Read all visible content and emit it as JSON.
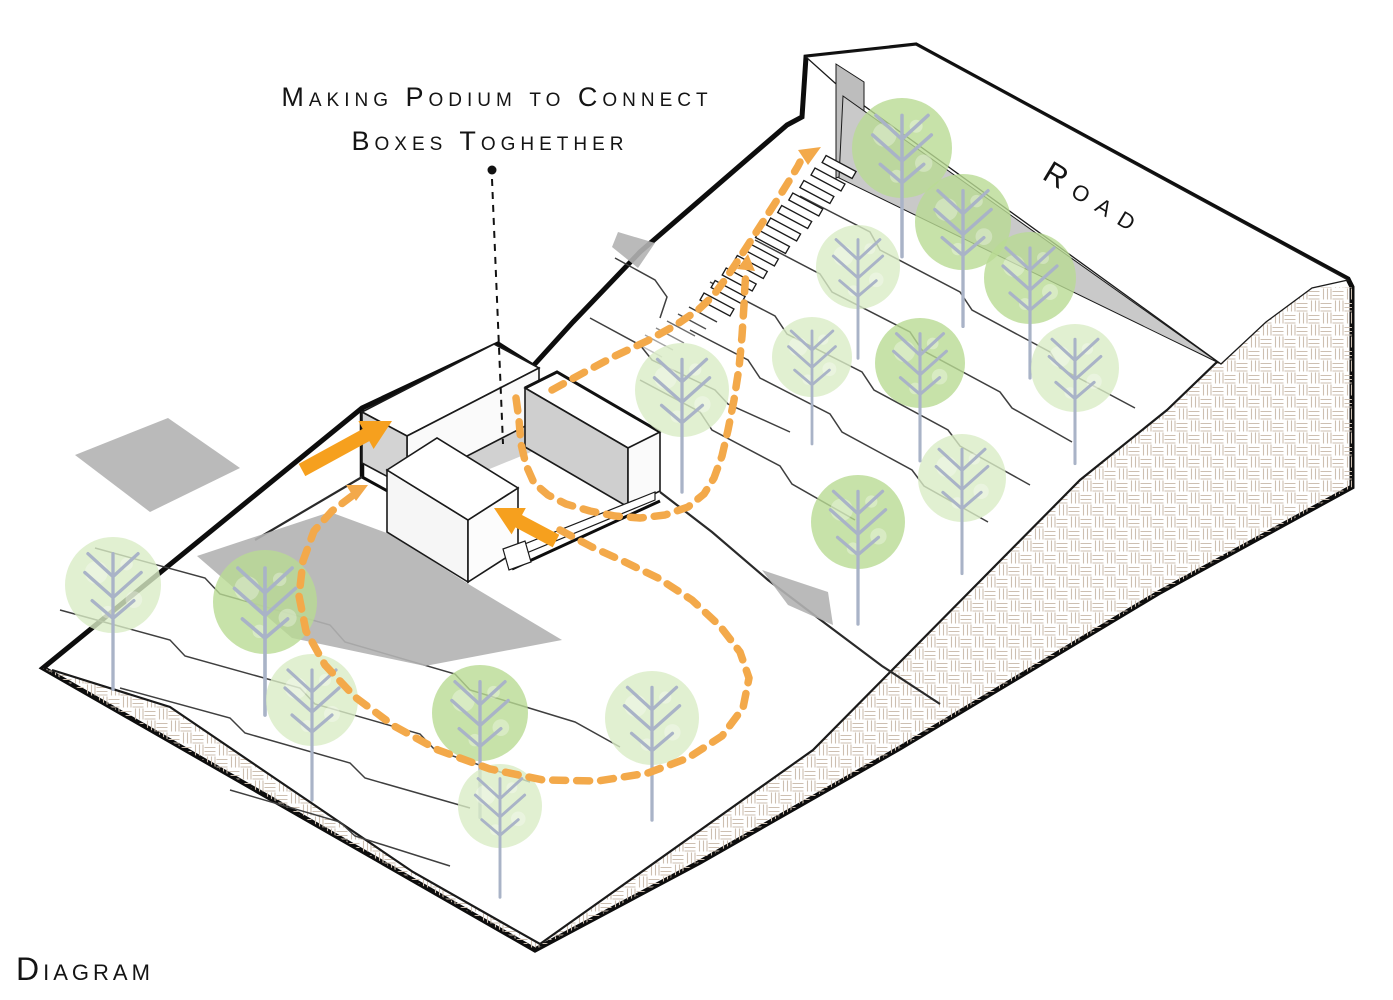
{
  "labels": {
    "title_line1": "Making Podium to Connect",
    "title_line2": "Boxes Toghether",
    "road": "Road",
    "diagram": "Diagram"
  },
  "colors": {
    "outline": "#0D0D0D",
    "line_medium": "#2A2A2A",
    "contour": "#3F3F3F",
    "hatch": "#CDBFB1",
    "wall_grey": "#C9C9C9",
    "wall_cap_grey": "#BDBDBD",
    "shadow_grey": "#B2B2B2",
    "box_side_grey": "#D3D3D3",
    "box_side_grey2": "#CFCFCF",
    "tree_light": "#D9ECC5",
    "tree_dark": "#B9DB94",
    "trunk": "#A9B3C7",
    "path_orange": "#F3A94A",
    "arrow_orange": "#F6A01E"
  },
  "scene": {
    "width": 1393,
    "height": 1000,
    "trees": [
      {
        "x": 113,
        "y": 585,
        "r": 48,
        "shade": "light"
      },
      {
        "x": 265,
        "y": 602,
        "r": 52,
        "shade": "dark"
      },
      {
        "x": 312,
        "y": 700,
        "r": 46,
        "shade": "light"
      },
      {
        "x": 480,
        "y": 713,
        "r": 48,
        "shade": "dark"
      },
      {
        "x": 500,
        "y": 806,
        "r": 42,
        "shade": "light"
      },
      {
        "x": 652,
        "y": 718,
        "r": 47,
        "shade": "light"
      },
      {
        "x": 682,
        "y": 390,
        "r": 47,
        "shade": "light"
      },
      {
        "x": 858,
        "y": 522,
        "r": 47,
        "shade": "dark"
      },
      {
        "x": 962,
        "y": 478,
        "r": 44,
        "shade": "light"
      },
      {
        "x": 902,
        "y": 148,
        "r": 50,
        "shade": "dark"
      },
      {
        "x": 963,
        "y": 222,
        "r": 48,
        "shade": "dark"
      },
      {
        "x": 1030,
        "y": 278,
        "r": 46,
        "shade": "dark"
      },
      {
        "x": 858,
        "y": 267,
        "r": 42,
        "shade": "light"
      },
      {
        "x": 812,
        "y": 357,
        "r": 40,
        "shade": "light"
      },
      {
        "x": 920,
        "y": 363,
        "r": 45,
        "shade": "dark"
      },
      {
        "x": 1075,
        "y": 368,
        "r": 44,
        "shade": "light"
      }
    ],
    "shapes": [
      {
        "t": "path",
        "name": "terrain-surface",
        "d": "M43,668 L362,408 L498,344 L533,366 L573,322 L640,252 L787,125 L802,117 L806,57 L916,45 L1348,279 L1352,287 L1352,487 L1160,592 L900,748 L700,862 L535,950 Z",
        "fill": "#FFFFFF",
        "stroke": "#0D0D0D",
        "w": 5
      },
      {
        "t": "path",
        "name": "cut-face-hatch",
        "d": "M43,668 L535,950 L700,862 L900,748 L1160,592 L1352,487 L1352,287 L1312,287 L1245,335 L1167,410 L1080,480 L813,750 L540,944 L413,872 L170,707 L52,670 Z",
        "fill": "url(#weave)"
      },
      {
        "t": "path",
        "name": "cut-face-inner-edge",
        "d": "M52,670 L170,707 L413,872 L540,944 L813,750 L1080,480 L1167,410 L1245,335 L1312,287",
        "stroke": "#1A1A1A",
        "w": 2.2
      },
      {
        "t": "path",
        "name": "contour-line",
        "d": "M95,548 L205,578 L220,594 L330,625 L345,642 L455,674 L470,690 L575,722 L620,747",
        "stroke": "#3F3F3F",
        "w": 1.5
      },
      {
        "t": "path",
        "name": "contour-line",
        "d": "M60,610 L170,640 L185,656 L300,688 L315,704 L420,734 L435,750 L530,782",
        "stroke": "#3F3F3F",
        "w": 1.5
      },
      {
        "t": "path",
        "name": "contour-line",
        "d": "M120,688 L230,718 L245,733 L350,763 L365,778 L470,808",
        "stroke": "#3F3F3F",
        "w": 1.5
      },
      {
        "t": "path",
        "name": "contour-line",
        "d": "M230,790 L340,822 L355,836 L450,866",
        "stroke": "#3F3F3F",
        "w": 1.5
      },
      {
        "t": "path",
        "name": "contour-line",
        "d": "M590,318 L640,345 L652,360 L715,390 L728,404 L790,432",
        "stroke": "#3F3F3F",
        "w": 1.5
      },
      {
        "t": "path",
        "name": "contour-line",
        "d": "M800,196 L870,232 L880,250 L960,292 L972,310 L1050,352 L1060,368 L1135,408",
        "stroke": "#3F3F3F",
        "w": 1.5
      },
      {
        "t": "path",
        "name": "contour-line",
        "d": "M755,240 L820,274 L832,292 L910,332 L922,350 L1000,392 L1012,408 L1072,442",
        "stroke": "#3F3F3F",
        "w": 1.5
      },
      {
        "t": "path",
        "name": "contour-line",
        "d": "M710,282 L775,316 L787,334 L862,372 L874,390 L948,430 L960,446 L1030,485",
        "stroke": "#3F3F3F",
        "w": 1.5
      },
      {
        "t": "path",
        "name": "contour-line",
        "d": "M690,330 L748,360 L760,378 L830,414 L842,432 L912,470 L924,486 L988,522",
        "stroke": "#3F3F3F",
        "w": 1.5
      },
      {
        "t": "path",
        "name": "contour-line",
        "d": "M640,380 L700,412 L712,430 L780,466 L792,484 L855,520",
        "stroke": "#3F3F3F",
        "w": 1.5
      },
      {
        "t": "path",
        "name": "contour-line",
        "d": "M615,258 L655,280 L667,297 L660,318",
        "stroke": "#3F3F3F",
        "w": 1.5
      },
      {
        "t": "path",
        "name": "terrain-break-line",
        "d": "M660,492 L712,532 L768,580 L826,624 L882,666 L940,704",
        "stroke": "#2A2A2A",
        "w": 2.2
      },
      {
        "t": "path",
        "name": "podium-corner-edge",
        "d": "M362,408 L362,477",
        "stroke": "#0D0D0D",
        "w": 4.5
      },
      {
        "t": "path",
        "name": "podium-base-edge",
        "d": "M362,477 L404,500",
        "stroke": "#0D0D0D",
        "w": 3
      },
      {
        "t": "path",
        "name": "podium-cut-edge",
        "d": "M362,477 L255,540",
        "stroke": "#2A2A2A",
        "w": 2.2
      },
      {
        "t": "poly",
        "name": "road-surface",
        "pts": "806,57 916,45 1348,280 1312,288 1266,322 1221,364 845,92",
        "fill": "#FFFFFF",
        "stroke": "#1A1A1A",
        "w": 1.3
      },
      {
        "t": "poly",
        "name": "road-wall-end",
        "pts": "836,64 864,82 864,168 836,178",
        "fill": "#BDBDBD",
        "stroke": "#1A1A1A",
        "w": 1
      },
      {
        "t": "poly",
        "name": "road-retaining-wall",
        "pts": "843,96 1219,363 839,178",
        "fill": "#C9C9C9",
        "stroke": "#1A1A1A",
        "w": 1
      },
      {
        "t": "stairs",
        "name": "stairs",
        "base": [
          700,
          300
        ],
        "n": 12,
        "step": [
          11.1,
          -12.5
        ],
        "tread": [
          30,
          16
        ],
        "riser": [
          4,
          -7
        ],
        "fill": "#FFFFFF",
        "stroke": "#1A1A1A",
        "w": 1.3
      },
      {
        "t": "ticks",
        "name": "stair-ticks",
        "start": [
          689,
          307
        ],
        "n": 6,
        "step": [
          -11,
          7
        ],
        "vec": [
          28,
          15
        ],
        "stroke": "#2A2A2A",
        "w": 1.4
      },
      {
        "t": "poly",
        "name": "shadow",
        "pts": "75,455 168,418 240,468 150,512",
        "fill": "#B2B2B2",
        "op": 0.9
      },
      {
        "t": "poly",
        "name": "shadow",
        "pts": "197,556 330,512 392,535 470,585 562,640 425,666 292,638",
        "fill": "#B2B2B2",
        "op": 0.9
      },
      {
        "t": "poly",
        "name": "shadow",
        "pts": "452,428 516,396 536,450 470,477",
        "fill": "#B2B2B2",
        "op": 0.6
      },
      {
        "t": "poly",
        "name": "shadow",
        "pts": "618,232 655,243 638,268 612,247",
        "fill": "#B2B2B2",
        "op": 0.9
      },
      {
        "t": "poly",
        "name": "shadow",
        "pts": "762,570 828,592 833,625 788,605",
        "fill": "#B2B2B2",
        "op": 0.9
      },
      {
        "t": "poly",
        "name": "box-a-top",
        "pts": "362,412 494,344 539,368 407,436",
        "fill": "#FFFFFF",
        "stroke": "#1A1A1A",
        "w": 1.6
      },
      {
        "t": "poly",
        "name": "box-a-face-se",
        "pts": "407,436 539,368 539,419 407,487",
        "fill": "#FAFAFA",
        "stroke": "#1A1A1A",
        "w": 1.6
      },
      {
        "t": "poly",
        "name": "box-a-face-sw",
        "pts": "362,412 407,436 407,487 362,463",
        "fill": "#D3D3D3",
        "stroke": "#1A1A1A",
        "w": 1.6
      },
      {
        "t": "poly",
        "name": "box-b-top",
        "pts": "525,388 557,372 660,432 628,448",
        "fill": "#FFFFFF",
        "stroke": "#1A1A1A",
        "w": 1.6
      },
      {
        "t": "poly",
        "name": "box-b-face-sw",
        "pts": "525,388 628,448 628,507 525,447",
        "fill": "#CFCFCF",
        "stroke": "#1A1A1A",
        "w": 1.6
      },
      {
        "t": "poly",
        "name": "box-b-face-se",
        "pts": "628,448 660,432 660,491 628,507",
        "fill": "#FAFAFA",
        "stroke": "#1A1A1A",
        "w": 1.6
      },
      {
        "t": "path",
        "name": "box-b-back-edge",
        "d": "M525,388 L557,372 L660,432",
        "stroke": "#111111",
        "w": 3
      },
      {
        "t": "poly",
        "name": "box-c-face-sw",
        "pts": "387,470 468,520 468,582 387,532",
        "fill": "#F6F6F6",
        "stroke": "#1A1A1A",
        "w": 1.6
      },
      {
        "t": "poly",
        "name": "box-c-face-se",
        "pts": "468,520 518,488 518,550 468,582",
        "fill": "#FCFCFC",
        "stroke": "#1A1A1A",
        "w": 1.6
      },
      {
        "t": "poly",
        "name": "box-c-top",
        "pts": "387,470 437,438 518,488 468,520",
        "fill": "#FFFFFF",
        "stroke": "#1A1A1A",
        "w": 1.6
      },
      {
        "t": "poly",
        "name": "podium-walkway",
        "pts": "507,551 655,492 655,500 507,561",
        "fill": "#FFFFFF",
        "stroke": "#1A1A1A",
        "w": 1.2
      },
      {
        "t": "path",
        "name": "podium-walkway-edge",
        "d": "M512,569 L660,501",
        "stroke": "#0D0D0D",
        "w": 3
      },
      {
        "t": "poly",
        "name": "podium-walkway-step",
        "pts": "503,549 525,541 531,562 509,570",
        "fill": "#FFFFFF",
        "stroke": "#1A1A1A",
        "w": 1.2
      },
      {
        "t": "trees",
        "name": "trees"
      },
      {
        "t": "path",
        "name": "circulation-loop-path",
        "d": "M560,530 L592,547 L625,562 L658,578 L692,600 L720,626 L740,652 L749,678 L743,708 L722,736 L688,758 L648,773 L598,781 L543,780 L490,769 L438,750 L394,726 L355,697 L325,665 L306,631 L299,596 L303,561 L314,531 L332,511 L352,496",
        "stroke": "#F3A94A",
        "w": 7.5,
        "dash": "13 11",
        "cap": "round"
      },
      {
        "t": "path",
        "name": "circulation-connector-path",
        "d": "M516,398 L519,420 L521,444 L526,465 L534,483 L548,495 L566,504 L590,511 L615,516 L640,518 L665,515 L688,507 L704,494 L714,478 L722,456 L728,430 L734,400 L739,368 L742,336 L744,305 L745,285 L746,272",
        "stroke": "#F3A94A",
        "w": 7.5,
        "dash": "13 11",
        "cap": "round"
      },
      {
        "t": "path",
        "name": "circulation-stairs-path",
        "d": "M552,390 L583,373 L615,356 L647,341 L676,325 L698,310 L713,296 L724,281 L735,265 L746,248 L757,231 L768,214 L779,197 L789,181 L798,166 L800,162",
        "stroke": "#F3A94A",
        "w": 7.5,
        "dash": "13 11",
        "cap": "round"
      },
      {
        "t": "poly",
        "name": "path-arrowhead",
        "pts": "368,485 356,501 346,485",
        "fill": "#F3A94A"
      },
      {
        "t": "poly",
        "name": "path-arrowhead",
        "pts": "821,147 808,165 798,150",
        "fill": "#F3A94A"
      },
      {
        "t": "poly",
        "name": "path-arrowhead",
        "pts": "748,254 755,271 737,269",
        "fill": "#F3A94A"
      },
      {
        "t": "poly",
        "name": "entry-arrow",
        "pts": "305.3,476.1 369.3,441.1 373.6,449 392,421 358.4,421 362.7,428.9 298.7,463.9",
        "fill": "#F6A01E"
      },
      {
        "t": "poly",
        "name": "entry-arrow",
        "pts": "559.3,534.8 522,515 525.8,508 494,508 511.6,534.4 515.4,527.4 552.7,547.2",
        "fill": "#F6A01E"
      },
      {
        "t": "circle",
        "name": "leader-dot",
        "cx": 492,
        "cy": 170,
        "r": 4.5,
        "fill": "#111111"
      },
      {
        "t": "path",
        "name": "leader-line",
        "d": "M492,179 L503,444",
        "stroke": "#111111",
        "w": 2,
        "dash": "7 6"
      }
    ]
  }
}
